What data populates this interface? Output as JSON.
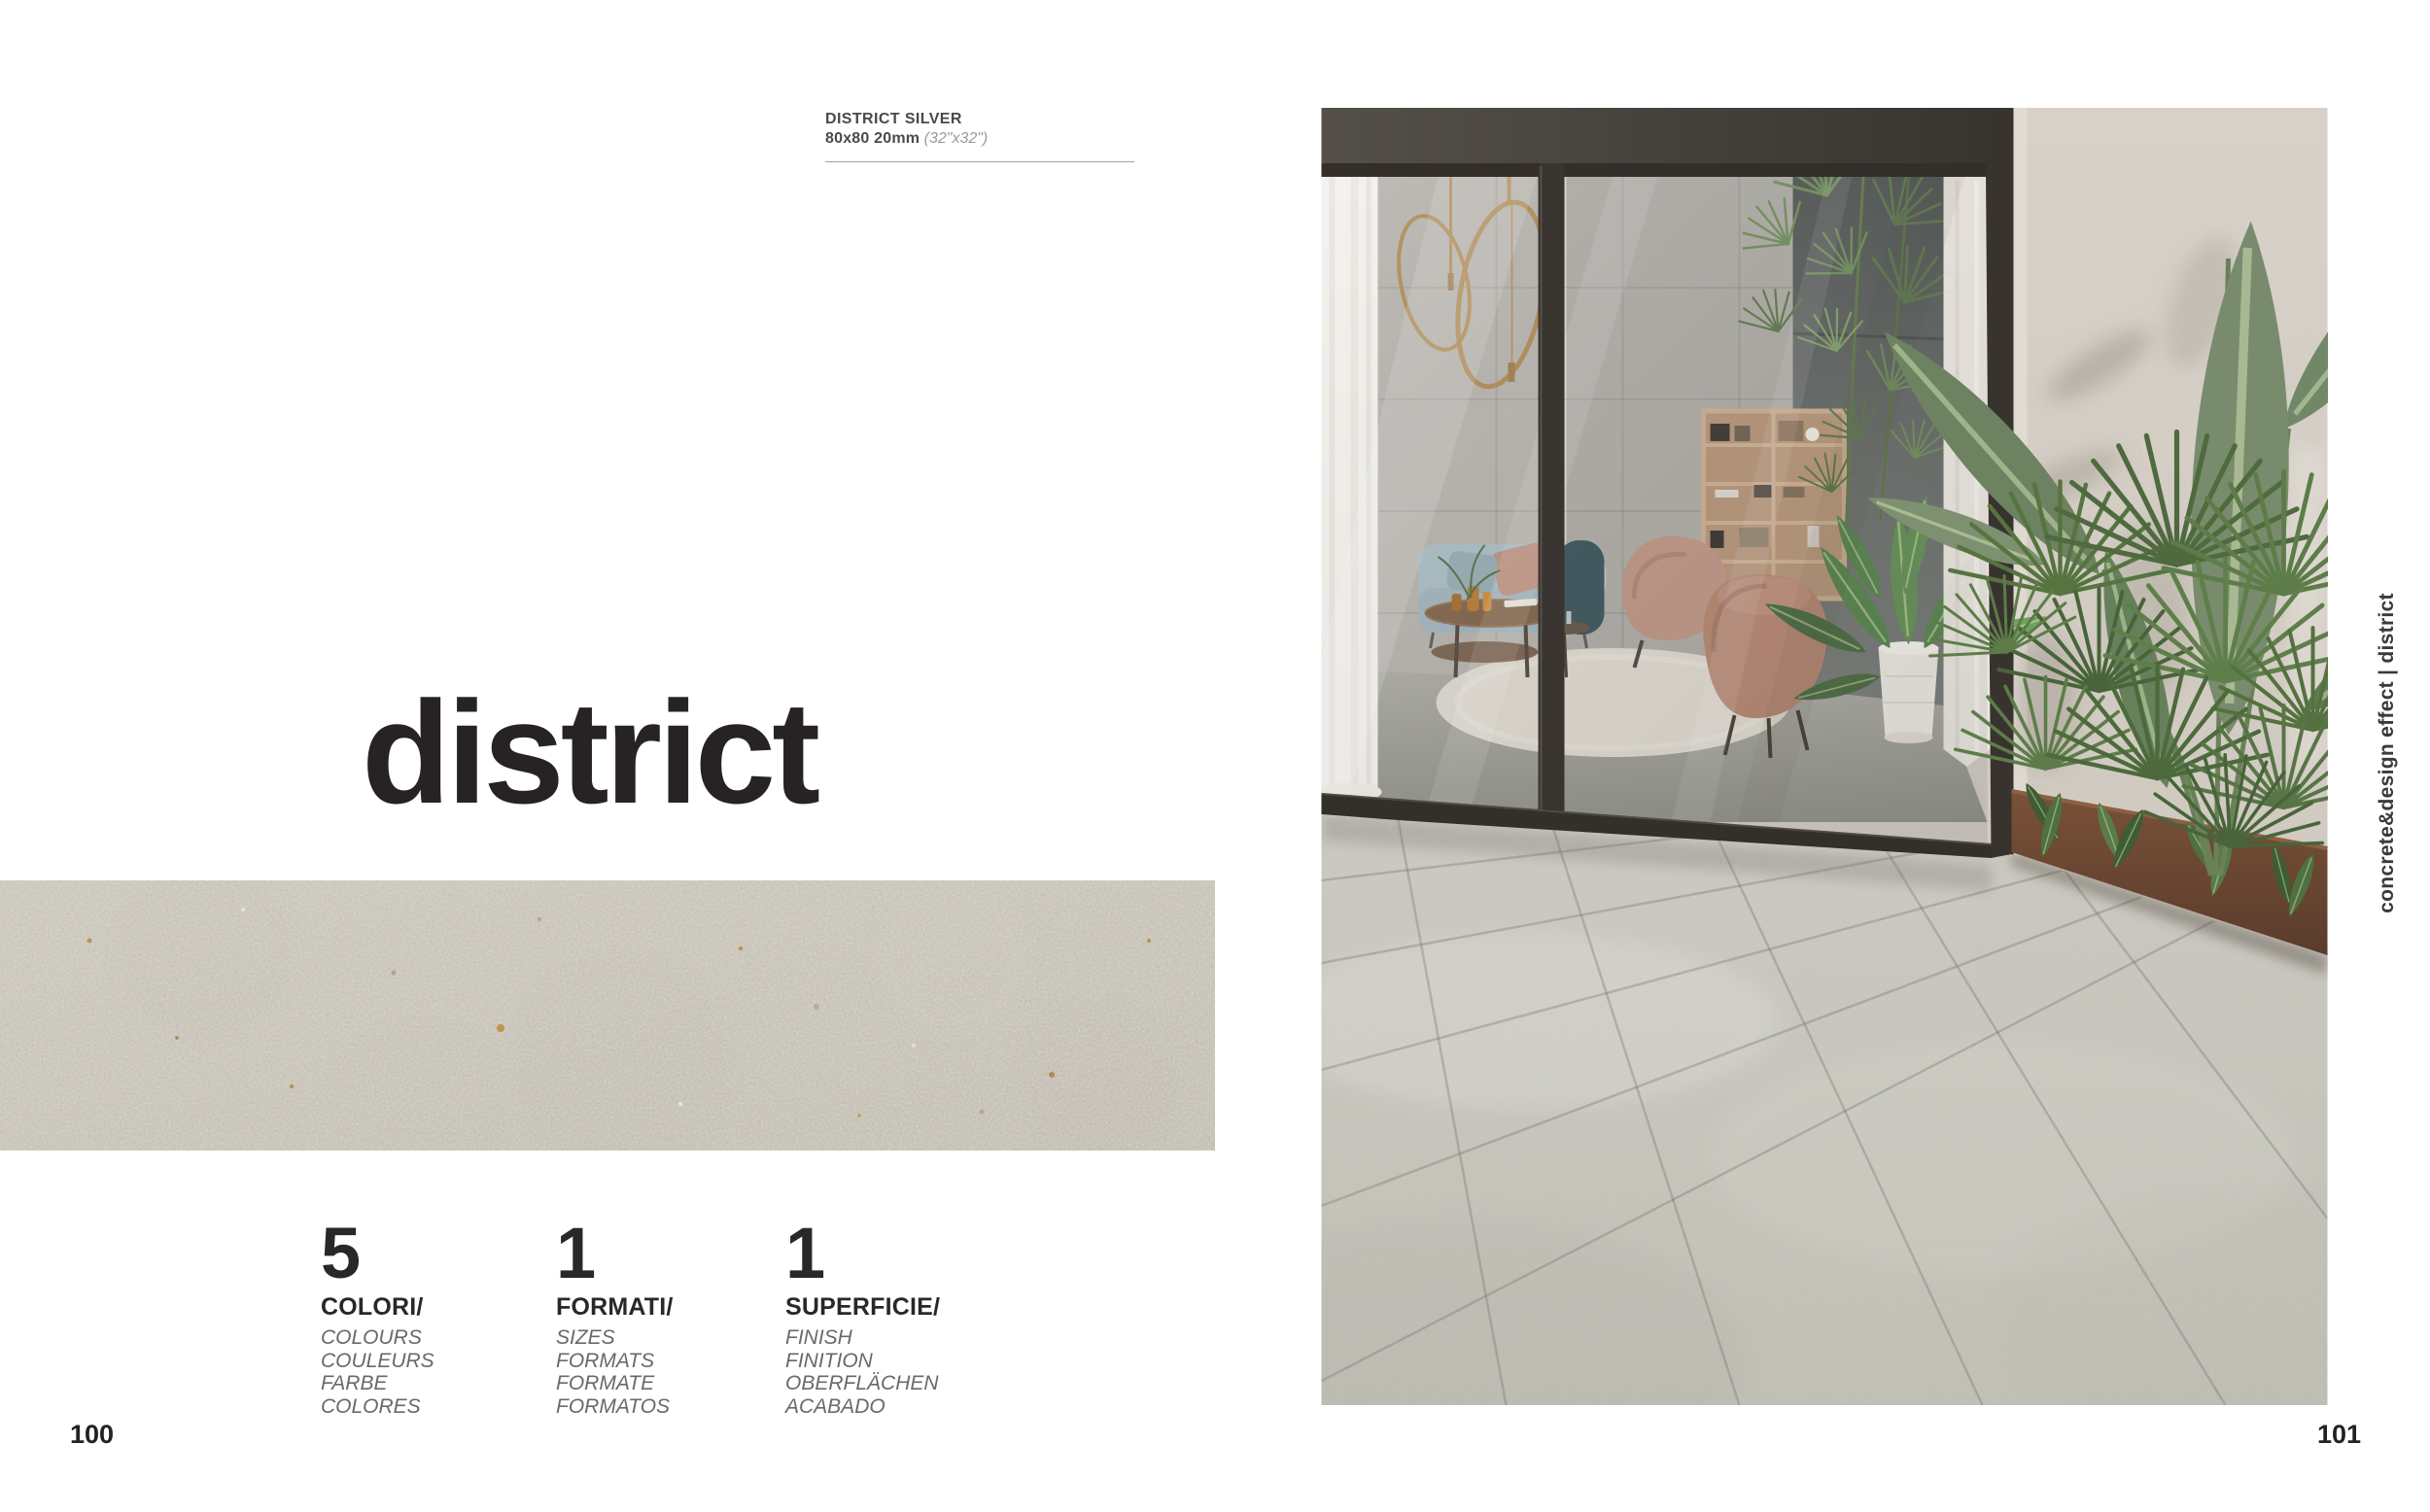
{
  "left_page": {
    "caption": {
      "product": "DISTRICT SILVER",
      "size": "80x80 20mm",
      "size_inches": "(32\"x32\")"
    },
    "title": "district",
    "stats": [
      {
        "number": "5",
        "label": "COLORI/",
        "items": [
          "COLOURS",
          "COULEURS",
          "FARBE",
          "COLORES"
        ]
      },
      {
        "number": "1",
        "label": "FORMATI/",
        "items": [
          "SIZES",
          "FORMATS",
          "FORMATE",
          "FORMATOS"
        ]
      },
      {
        "number": "1",
        "label": "SUPERFICIE/",
        "items": [
          "FINISH",
          "FINITION",
          "OBERFLÄCHEN",
          "ACABADO"
        ]
      }
    ],
    "page_number": "100"
  },
  "right_page": {
    "sidebar_text": "concrete&design effect | district",
    "page_number": "101"
  },
  "palette": {
    "page_background": "#ffffff",
    "text_dark": "#272324",
    "text_gray_italic": "#6a6969",
    "caption_gray": "#4b4a49",
    "caption_light_italic": "#9b9a98",
    "swatch_stone": "#c6c1b5",
    "photo_wall_beige": "#d3cdc5",
    "photo_tile_gray": "#c6c5bc",
    "frame_bronze": "#36312d",
    "plant_green": "#5d7c49",
    "shelf_wood": "#c2a283",
    "sofa_blue": "#a7b9c1",
    "armchair_tan": "#b2826d",
    "pendant_brass": "#ab854d",
    "planter_corten": "#6e4934"
  }
}
